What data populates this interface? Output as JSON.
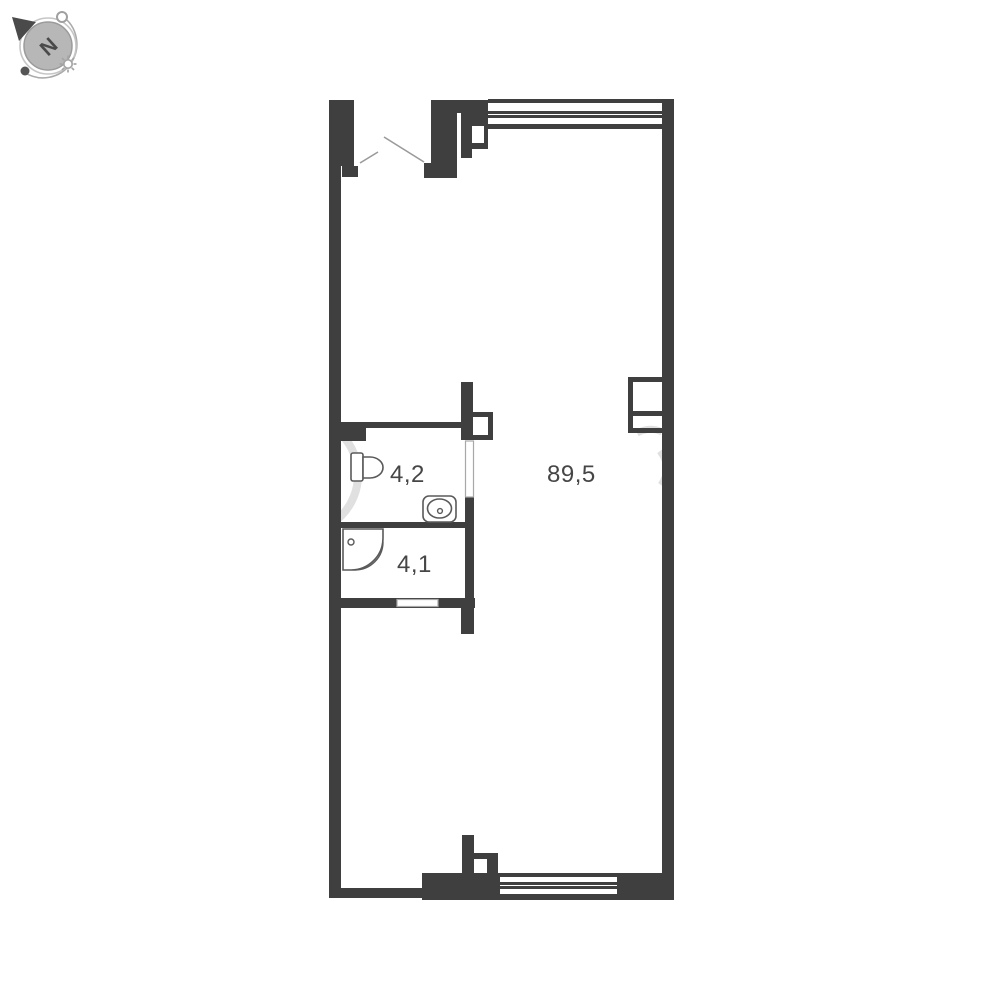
{
  "floor_plan": {
    "type": "apartment-floor-plan",
    "rooms": [
      {
        "id": "main-room",
        "area_label": "89,5"
      },
      {
        "id": "wc-room",
        "area_label": "4,2"
      },
      {
        "id": "shower-room",
        "area_label": "4,1"
      }
    ],
    "compass": {
      "north_label": "N"
    },
    "fixtures": [
      "toilet",
      "sink",
      "shower-tray"
    ],
    "openings": [
      "entrance-door",
      "wc-door",
      "shower-room-door",
      "top-window",
      "bottom-window"
    ]
  },
  "colors": {
    "wall": "#3f3f3f",
    "line_thin": "#9a9a9a",
    "fixture": "#5a5a5a",
    "watermark": "#c7c7c7",
    "label_text": "#464646",
    "compass_gray": "#b7b7b7",
    "compass_dark": "#4a4a4a"
  }
}
